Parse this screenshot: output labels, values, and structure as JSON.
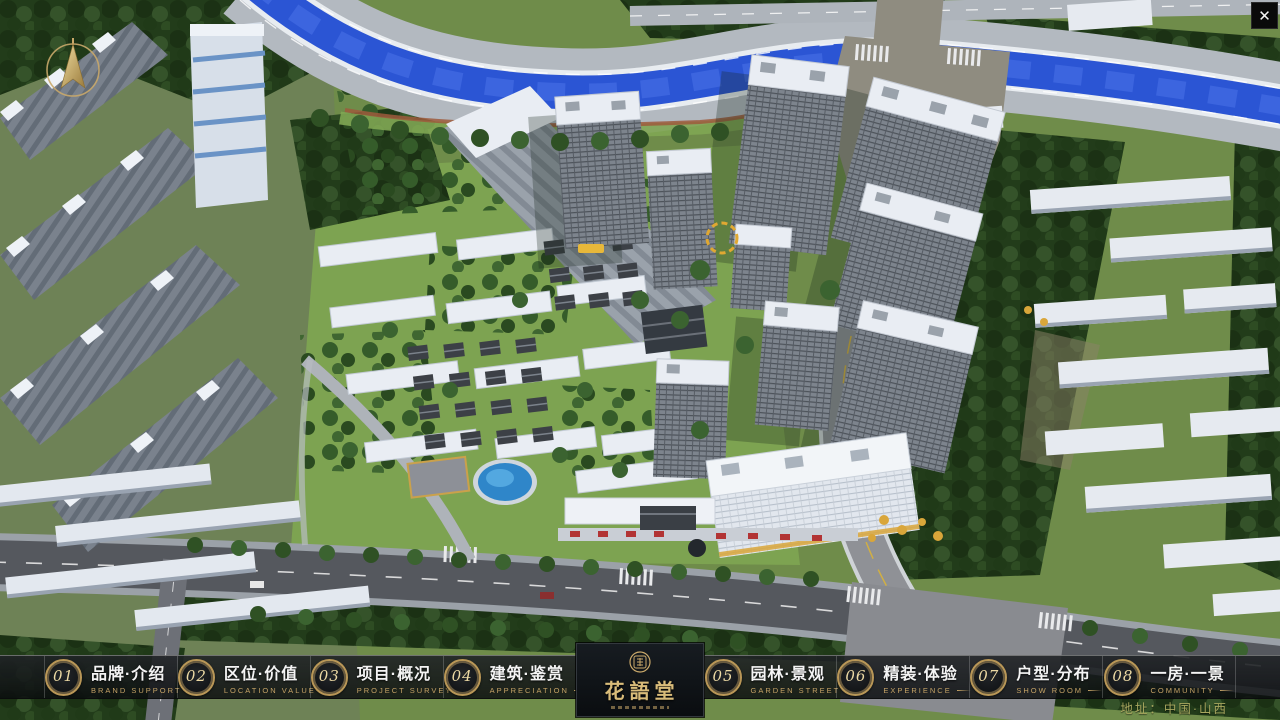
{
  "window": {
    "close_glyph": "✕"
  },
  "nav": {
    "items": [
      {
        "num": "01",
        "label": "品牌·介绍",
        "sub": "BRAND SUPPORT"
      },
      {
        "num": "02",
        "label": "区位·价值",
        "sub": "LOCATION VALUE"
      },
      {
        "num": "03",
        "label": "项目·概况",
        "sub": "PROJECT SURVEY"
      },
      {
        "num": "04",
        "label": "建筑·鉴赏",
        "sub": "APPRECIATION"
      },
      {
        "num": "05",
        "label": "园林·景观",
        "sub": "GARDEN STREET"
      },
      {
        "num": "06",
        "label": "精装·体验",
        "sub": "EXPERIENCE"
      },
      {
        "num": "07",
        "label": "户型·分布",
        "sub": "SHOW ROOM"
      },
      {
        "num": "08",
        "label": "一房·一景",
        "sub": "COMMUNITY"
      }
    ]
  },
  "logo": {
    "title": "花語堂"
  },
  "footer": {
    "address": "地址：中国·山西"
  },
  "colors": {
    "accent_gold": "#c9a86a",
    "panel_dark": "#0b0e11",
    "river_blue": "#2b55d4"
  }
}
